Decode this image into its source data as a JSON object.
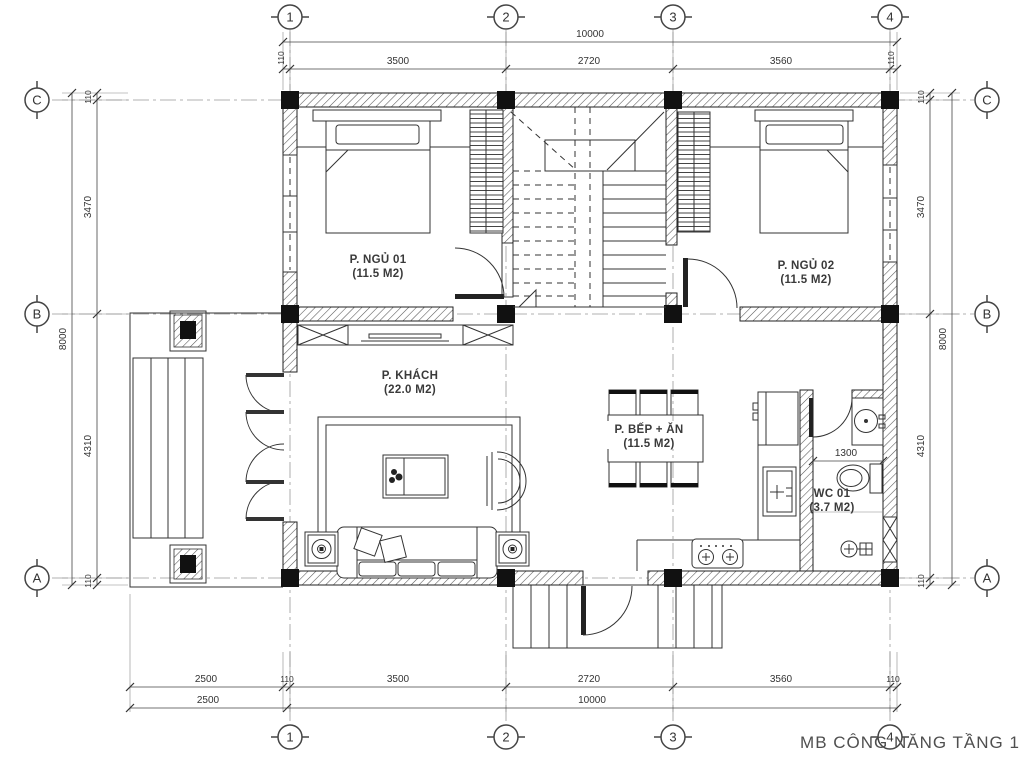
{
  "title": "MB CÔNG NĂNG TẦNG 1",
  "grid": {
    "cols": [
      "1",
      "2",
      "3",
      "4"
    ],
    "rows": [
      "C",
      "B",
      "A"
    ]
  },
  "dims": {
    "top": {
      "overall": "10000",
      "segments": [
        "110",
        "3500",
        "2720",
        "3560",
        "110"
      ]
    },
    "bottom": {
      "row1": [
        "2500",
        "110",
        "3500",
        "2720",
        "3560",
        "110"
      ],
      "row2": [
        "2500",
        "10000"
      ]
    },
    "side": {
      "overall": "8000",
      "segments": [
        "110",
        "3470",
        "4310",
        "110"
      ]
    },
    "wc_width": "1300"
  },
  "rooms": {
    "bedroom1": {
      "name": "P. NGỦ 01",
      "area": "(11.5 M2)"
    },
    "bedroom2": {
      "name": "P. NGỦ 02",
      "area": "(11.5 M2)"
    },
    "living": {
      "name": "P. KHÁCH",
      "area": "(22.0 M2)"
    },
    "kitchen": {
      "name": "P. BẾP + ĂN",
      "area": "(11.5 M2)"
    },
    "wc": {
      "name": "WC 01",
      "area": "(3.7 M2)"
    }
  },
  "colors": {
    "line": "#333333",
    "wall_hatch": "#555555",
    "text": "#3a3a3a",
    "background": "#ffffff"
  }
}
